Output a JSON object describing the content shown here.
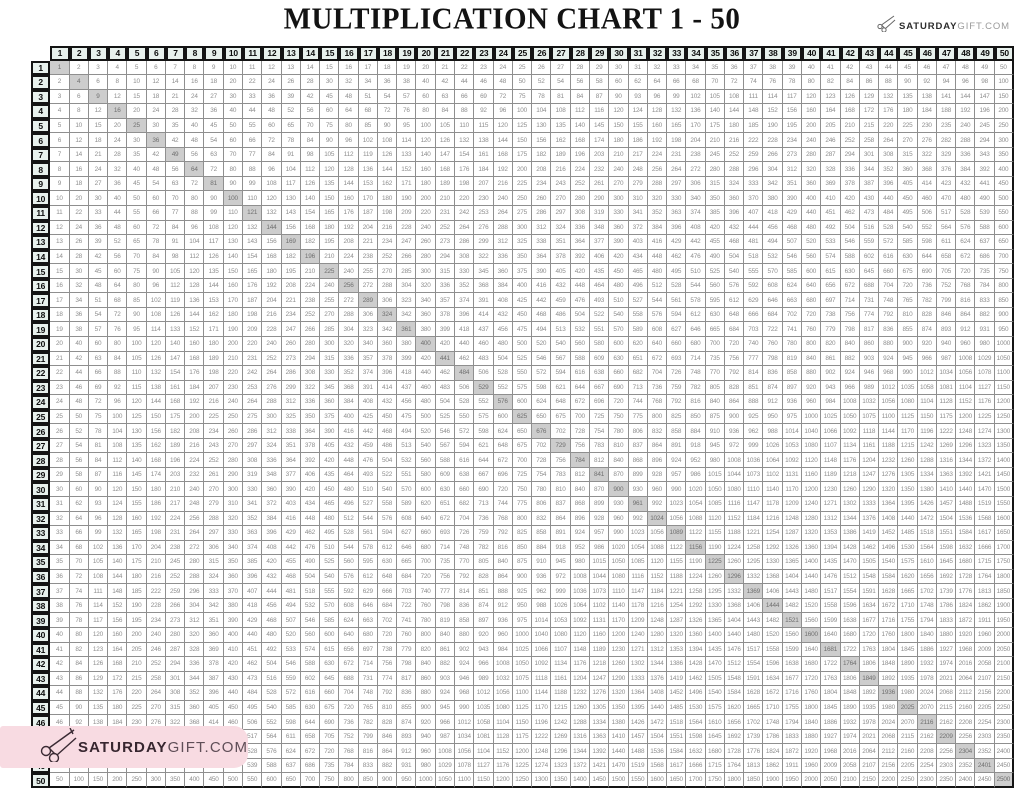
{
  "title": "MULTIPLICATION CHART 1 - 50",
  "brand": {
    "logo_bold": "SATURDAY",
    "logo_light": "GIFT.COM",
    "badge_bold": "SATURDAY",
    "badge_light": "GIFT.COM",
    "scissors_icon": "scissors-icon"
  },
  "colors": {
    "header_bg": "#e8f1ed",
    "grid_thick_border": "#141414",
    "grid_thin_border": "#8f8f8f",
    "cell_text": "#8e8e8e",
    "diagonal_highlight_bg": "#cdcdcd",
    "badge_pink": "#f8dbe2",
    "badge_text_dark": "#37262f"
  },
  "chart_data": {
    "type": "table",
    "title": "MULTIPLICATION CHART 1 - 50",
    "row_headers": [
      1,
      2,
      3,
      4,
      5,
      6,
      7,
      8,
      9,
      10,
      11,
      12,
      13,
      14,
      15,
      16,
      17,
      18,
      19,
      20,
      21,
      22,
      23,
      24,
      25,
      26,
      27,
      28,
      29,
      30,
      31,
      32,
      33,
      34,
      35,
      36,
      37,
      38,
      39,
      40,
      41,
      42,
      43,
      44,
      45,
      46,
      47,
      48,
      49,
      50
    ],
    "col_headers": [
      1,
      2,
      3,
      4,
      5,
      6,
      7,
      8,
      9,
      10,
      11,
      12,
      13,
      14,
      15,
      16,
      17,
      18,
      19,
      20,
      21,
      22,
      23,
      24,
      25,
      26,
      27,
      28,
      29,
      30,
      31,
      32,
      33,
      34,
      35,
      36,
      37,
      38,
      39,
      40,
      41,
      42,
      43,
      44,
      45,
      46,
      47,
      48,
      49,
      50
    ],
    "cell_rule": "each body cell = row header × column header (products 1 to 2500)",
    "highlight": "perfect-square diagonal cells (1,4,9,...,2500) shaded gray",
    "grid": "on",
    "corner_cell": "empty"
  }
}
